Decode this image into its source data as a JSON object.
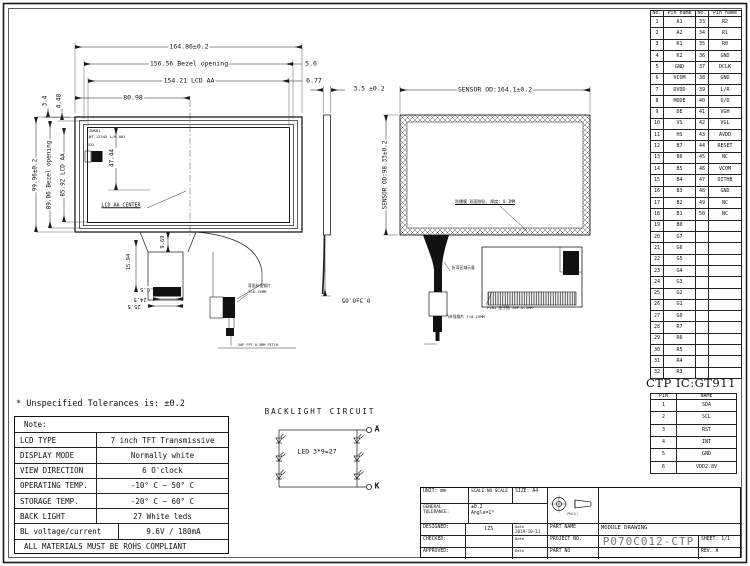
{
  "front_view": {
    "dim_width_outline": "164.86±0.2",
    "dim_width_bezel": "156.56 Bezel opening",
    "dim_width_aa": "154.21 LCD AA",
    "dim_center_offset": "80.98",
    "dim_right_top": "5.6",
    "dim_right_aa": "6.77",
    "dim_left_top_1": "3.4",
    "dim_left_top_2": "4.48",
    "dim_height_outline": "99.96±0.2",
    "dim_height_bezel": "89.06 Bezel opening",
    "dim_height_aa": "85.92 LCD AA",
    "dim_aa_center": "47.44",
    "label_aa_center": "LCD AA CENTER",
    "tiny_note_line1": "INK01",
    "tiny_note_line2": "WT.12345 L/N-001",
    "tiny_note_line3": "XXX",
    "tail": {
      "dim_1": "9.69",
      "dim_2": "15.94",
      "dim_3": "0.5",
      "dim_4": "24.5",
      "dim_5": "25.5",
      "stiffener_note_line1": "背面补强钢片",
      "stiffener_note_line2": "T=0.15MM",
      "connector_note": "50P FPC 0.5MM PITCH"
    }
  },
  "side_view": {
    "dim_thickness": "3.5 ±0.2"
  },
  "sensor_view": {
    "dim_width": "SENSOR OD:164.1±0.2",
    "dim_height": "SENSOR OD:98.33±0.2",
    "adhesive_note": "防爆膜 双面胶贴, 厚度: 0.1MM",
    "dim_gap": "0.3±0.05",
    "tail_note": "折弯区域示意",
    "stiffener_note": "补强钢片 T=0.15MM",
    "detail_note": "PIN1 金手指 50P-0.5MM"
  },
  "pin_table": {
    "headers": [
      "No.",
      "Pin name",
      "No.",
      "Pin name"
    ],
    "rows": [
      [
        "1",
        "A1",
        "33",
        "R2"
      ],
      [
        "2",
        "A2",
        "34",
        "R1"
      ],
      [
        "3",
        "K1",
        "35",
        "R0"
      ],
      [
        "4",
        "K2",
        "36",
        "GND"
      ],
      [
        "5",
        "GND",
        "37",
        "DCLK"
      ],
      [
        "6",
        "VCOM",
        "38",
        "GND"
      ],
      [
        "7",
        "DVDD",
        "39",
        "L/R"
      ],
      [
        "8",
        "MODE",
        "40",
        "U/D"
      ],
      [
        "9",
        "DE",
        "41",
        "VGH"
      ],
      [
        "10",
        "VS",
        "42",
        "VGL"
      ],
      [
        "11",
        "HS",
        "43",
        "AVDD"
      ],
      [
        "12",
        "B7",
        "44",
        "RESET"
      ],
      [
        "13",
        "B6",
        "45",
        "NC"
      ],
      [
        "14",
        "B5",
        "46",
        "VCOM"
      ],
      [
        "15",
        "B4",
        "47",
        "DITHB"
      ],
      [
        "16",
        "B3",
        "48",
        "GND"
      ],
      [
        "17",
        "B2",
        "49",
        "NC"
      ],
      [
        "18",
        "B1",
        "50",
        "NC"
      ],
      [
        "19",
        "B0",
        "",
        ""
      ],
      [
        "20",
        "G7",
        "",
        ""
      ],
      [
        "21",
        "G6",
        "",
        ""
      ],
      [
        "22",
        "G5",
        "",
        ""
      ],
      [
        "23",
        "G4",
        "",
        ""
      ],
      [
        "24",
        "G3",
        "",
        ""
      ],
      [
        "25",
        "G2",
        "",
        ""
      ],
      [
        "26",
        "G1",
        "",
        ""
      ],
      [
        "27",
        "G0",
        "",
        ""
      ],
      [
        "28",
        "R7",
        "",
        ""
      ],
      [
        "29",
        "R6",
        "",
        ""
      ],
      [
        "30",
        "R5",
        "",
        ""
      ],
      [
        "31",
        "R4",
        "",
        ""
      ],
      [
        "32",
        "R3",
        "",
        ""
      ]
    ]
  },
  "ctp_table": {
    "title": "CTP IC:GT911",
    "headers": [
      "PIN",
      "NAME"
    ],
    "rows": [
      [
        "1",
        "SDA"
      ],
      [
        "2",
        "SCL"
      ],
      [
        "3",
        "RST"
      ],
      [
        "4",
        "INT"
      ],
      [
        "5",
        "GND"
      ],
      [
        "6",
        "VDD2.8V"
      ]
    ]
  },
  "notes": {
    "tolerance_note": "* Unspecified Tolerances is: ±0.2",
    "header": "Note:",
    "rows": [
      {
        "label": "LCD TYPE",
        "value": "7 inch TFT Transmissive"
      },
      {
        "label": "DISPLAY MODE",
        "value": "Normally white"
      },
      {
        "label": "VIEW DIRECTION",
        "value": "6 O'clock"
      },
      {
        "label": "OPERATING TEMP.",
        "value": "-10° C ~ 50° C"
      },
      {
        "label": "STORAGE TEMP.",
        "value": "-20° C ~ 60° C"
      },
      {
        "label": "BACK LIGHT",
        "value": "27 White leds"
      },
      {
        "label": "BL voltage/current",
        "value": "9.6V / 180mA"
      }
    ],
    "footer": "ALL MATERIALS MUST BE ROHS COMPLIANT"
  },
  "backlight": {
    "title": "BACKLIGHT CIRCUIT",
    "label": "LED 3*9=27",
    "terminal_a": "A",
    "terminal_k": "K"
  },
  "title_block": {
    "unit": "UNIT: mm",
    "scale": "SCALE:NO SCALE",
    "size": "SIZE: A4",
    "general_tolerance_label": "GENERAL TOLERANCE:",
    "tolerance_value": "±0.2",
    "angle_value": "Angle=1°",
    "designed_label": "DESIGNED:",
    "designed_value": "CZS",
    "checked_label": "CHECKED:",
    "approved_label": "APPROVED:",
    "date_label": "Date",
    "date_value": "2019-10-11",
    "part_name_label": "PART NAME",
    "part_name_value": "MODULE DRAWING",
    "project_no_label": "PROJECT NO.",
    "project_no_value": "P070C012-CTP",
    "part_no_label": "PART NO",
    "sheet_label": "SHEET: 1/1",
    "rev_label": "REV. A",
    "projection_label": "PROJ()"
  }
}
